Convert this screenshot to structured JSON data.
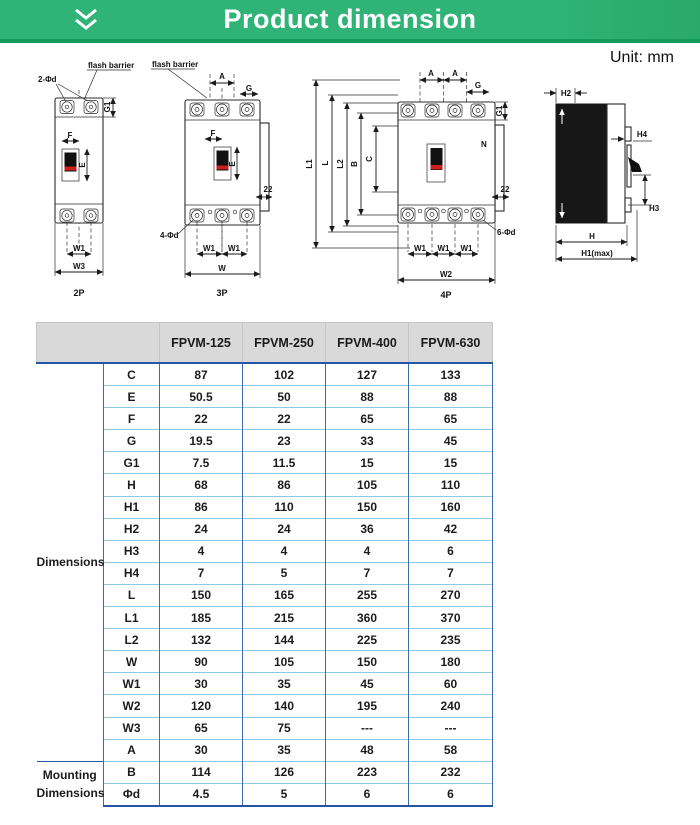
{
  "header": {
    "title": "Product dimension"
  },
  "unit_label": "Unit: mm",
  "colors": {
    "green": "#2fb376",
    "green2": "#29a96c",
    "green-dark": "#159a5e",
    "header-bg": "#d9d9d9",
    "border-v": "#3b6db6",
    "border-h": "#8ec9e8",
    "navy": "#2456a4",
    "red": "#c9201d"
  },
  "diagrams": {
    "d2p": {
      "flash_barrier": "flash barrier",
      "holes": "2-Φd",
      "g1": "G1",
      "f": "F",
      "e": "E",
      "w1": "W1",
      "w3": "W3",
      "caption": "2P"
    },
    "d3p": {
      "flash_barrier": "flash barrier",
      "a": "A",
      "g": "G",
      "f": "F",
      "e": "E",
      "tab": "22",
      "holes": "4-Φd",
      "w1a": "W1",
      "w1b": "W1",
      "w": "W",
      "caption": "3P"
    },
    "d4p": {
      "a1": "A",
      "a2": "A",
      "g": "G",
      "g1": "G1",
      "l1": "L1",
      "l": "L",
      "l2": "L2",
      "b": "B",
      "c": "C",
      "n": "N",
      "tab": "22",
      "holes": "6-Φd",
      "w1a": "W1",
      "w1b": "W1",
      "w1c": "W1",
      "w2": "W2",
      "caption": "4P"
    },
    "dside": {
      "h2": "H2",
      "h4": "H4",
      "h3": "H3",
      "h": "H",
      "h1": "H1(max)"
    }
  },
  "table": {
    "col_headers": [
      "FPVM-125",
      "FPVM-250",
      "FPVM-400",
      "FPVM-630"
    ],
    "groups": [
      {
        "label": "Dimensions",
        "rows": [
          {
            "param": "C",
            "values": [
              "87",
              "102",
              "127",
              "133"
            ]
          },
          {
            "param": "E",
            "values": [
              "50.5",
              "50",
              "88",
              "88"
            ]
          },
          {
            "param": "F",
            "values": [
              "22",
              "22",
              "65",
              "65"
            ]
          },
          {
            "param": "G",
            "values": [
              "19.5",
              "23",
              "33",
              "45"
            ]
          },
          {
            "param": "G1",
            "values": [
              "7.5",
              "11.5",
              "15",
              "15"
            ]
          },
          {
            "param": "H",
            "values": [
              "68",
              "86",
              "105",
              "110"
            ]
          },
          {
            "param": "H1",
            "values": [
              "86",
              "110",
              "150",
              "160"
            ]
          },
          {
            "param": "H2",
            "values": [
              "24",
              "24",
              "36",
              "42"
            ]
          },
          {
            "param": "H3",
            "values": [
              "4",
              "4",
              "4",
              "6"
            ]
          },
          {
            "param": "H4",
            "values": [
              "7",
              "5",
              "7",
              "7"
            ]
          },
          {
            "param": "L",
            "values": [
              "150",
              "165",
              "255",
              "270"
            ]
          },
          {
            "param": "L1",
            "values": [
              "185",
              "215",
              "360",
              "370"
            ]
          },
          {
            "param": "L2",
            "values": [
              "132",
              "144",
              "225",
              "235"
            ]
          },
          {
            "param": "W",
            "values": [
              "90",
              "105",
              "150",
              "180"
            ]
          },
          {
            "param": "W1",
            "values": [
              "30",
              "35",
              "45",
              "60"
            ]
          },
          {
            "param": "W2",
            "values": [
              "120",
              "140",
              "195",
              "240"
            ]
          },
          {
            "param": "W3",
            "values": [
              "65",
              "75",
              "---",
              "---"
            ]
          },
          {
            "param": "A",
            "values": [
              "30",
              "35",
              "48",
              "58"
            ]
          }
        ]
      },
      {
        "label": "Mounting Dimensions",
        "rows": [
          {
            "param": "B",
            "values": [
              "114",
              "126",
              "223",
              "232"
            ]
          },
          {
            "param": "Φd",
            "values": [
              "4.5",
              "5",
              "6",
              "6"
            ]
          }
        ]
      }
    ]
  }
}
